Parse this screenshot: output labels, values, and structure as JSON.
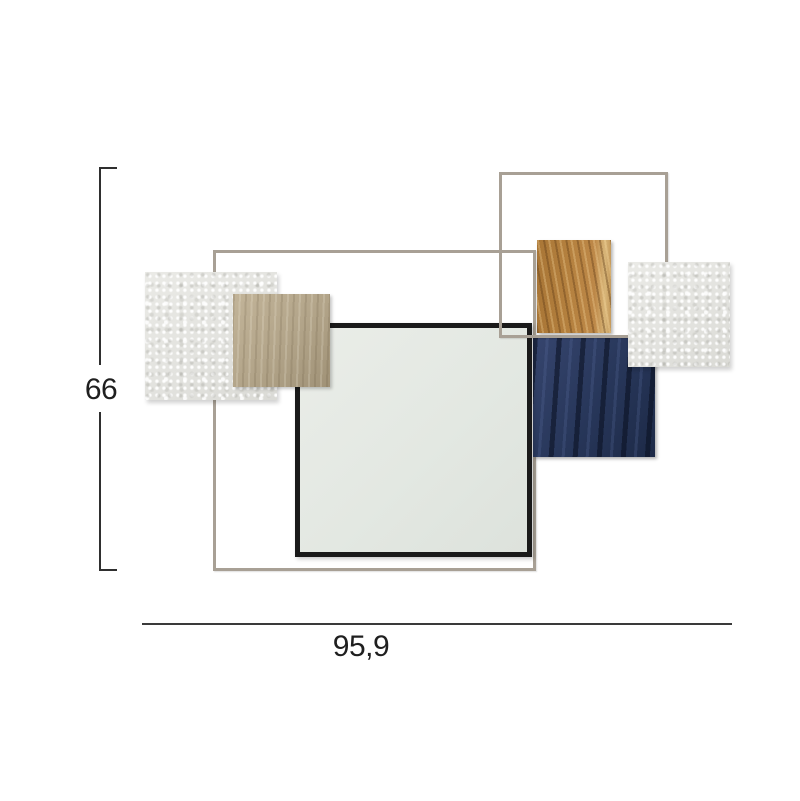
{
  "figure": {
    "type": "product-dimension-diagram",
    "subject": "geometric wall-mounted mirror art with layered square panels and metal wire frames"
  },
  "dimensions": {
    "height_label": "66",
    "width_label": "95,9"
  },
  "artwork": {
    "frames": [
      {
        "name": "large-metal-wire-frame",
        "color": "#a8a095"
      },
      {
        "name": "small-metal-wire-frame",
        "color": "#a8a095"
      }
    ],
    "panels": [
      {
        "name": "textured-white-panel-left",
        "material": "stucco",
        "color": "#e5e5e1"
      },
      {
        "name": "beige-wood-panel",
        "material": "wood",
        "color": "#b3a58a"
      },
      {
        "name": "oak-wood-panel",
        "material": "oak wood",
        "color": "#b5813f"
      },
      {
        "name": "navy-blue-panel",
        "material": "painted wood",
        "color": "#273659"
      },
      {
        "name": "textured-white-panel-right",
        "material": "stucco",
        "color": "#e5e5e1"
      },
      {
        "name": "mirror",
        "frame_color": "#1a1a1a",
        "glass_color": "#e3e8e2"
      }
    ]
  },
  "colors": {
    "background": "#ffffff",
    "dimension_line": "#2f2f2f",
    "dimension_text": "#1f1f1f"
  }
}
